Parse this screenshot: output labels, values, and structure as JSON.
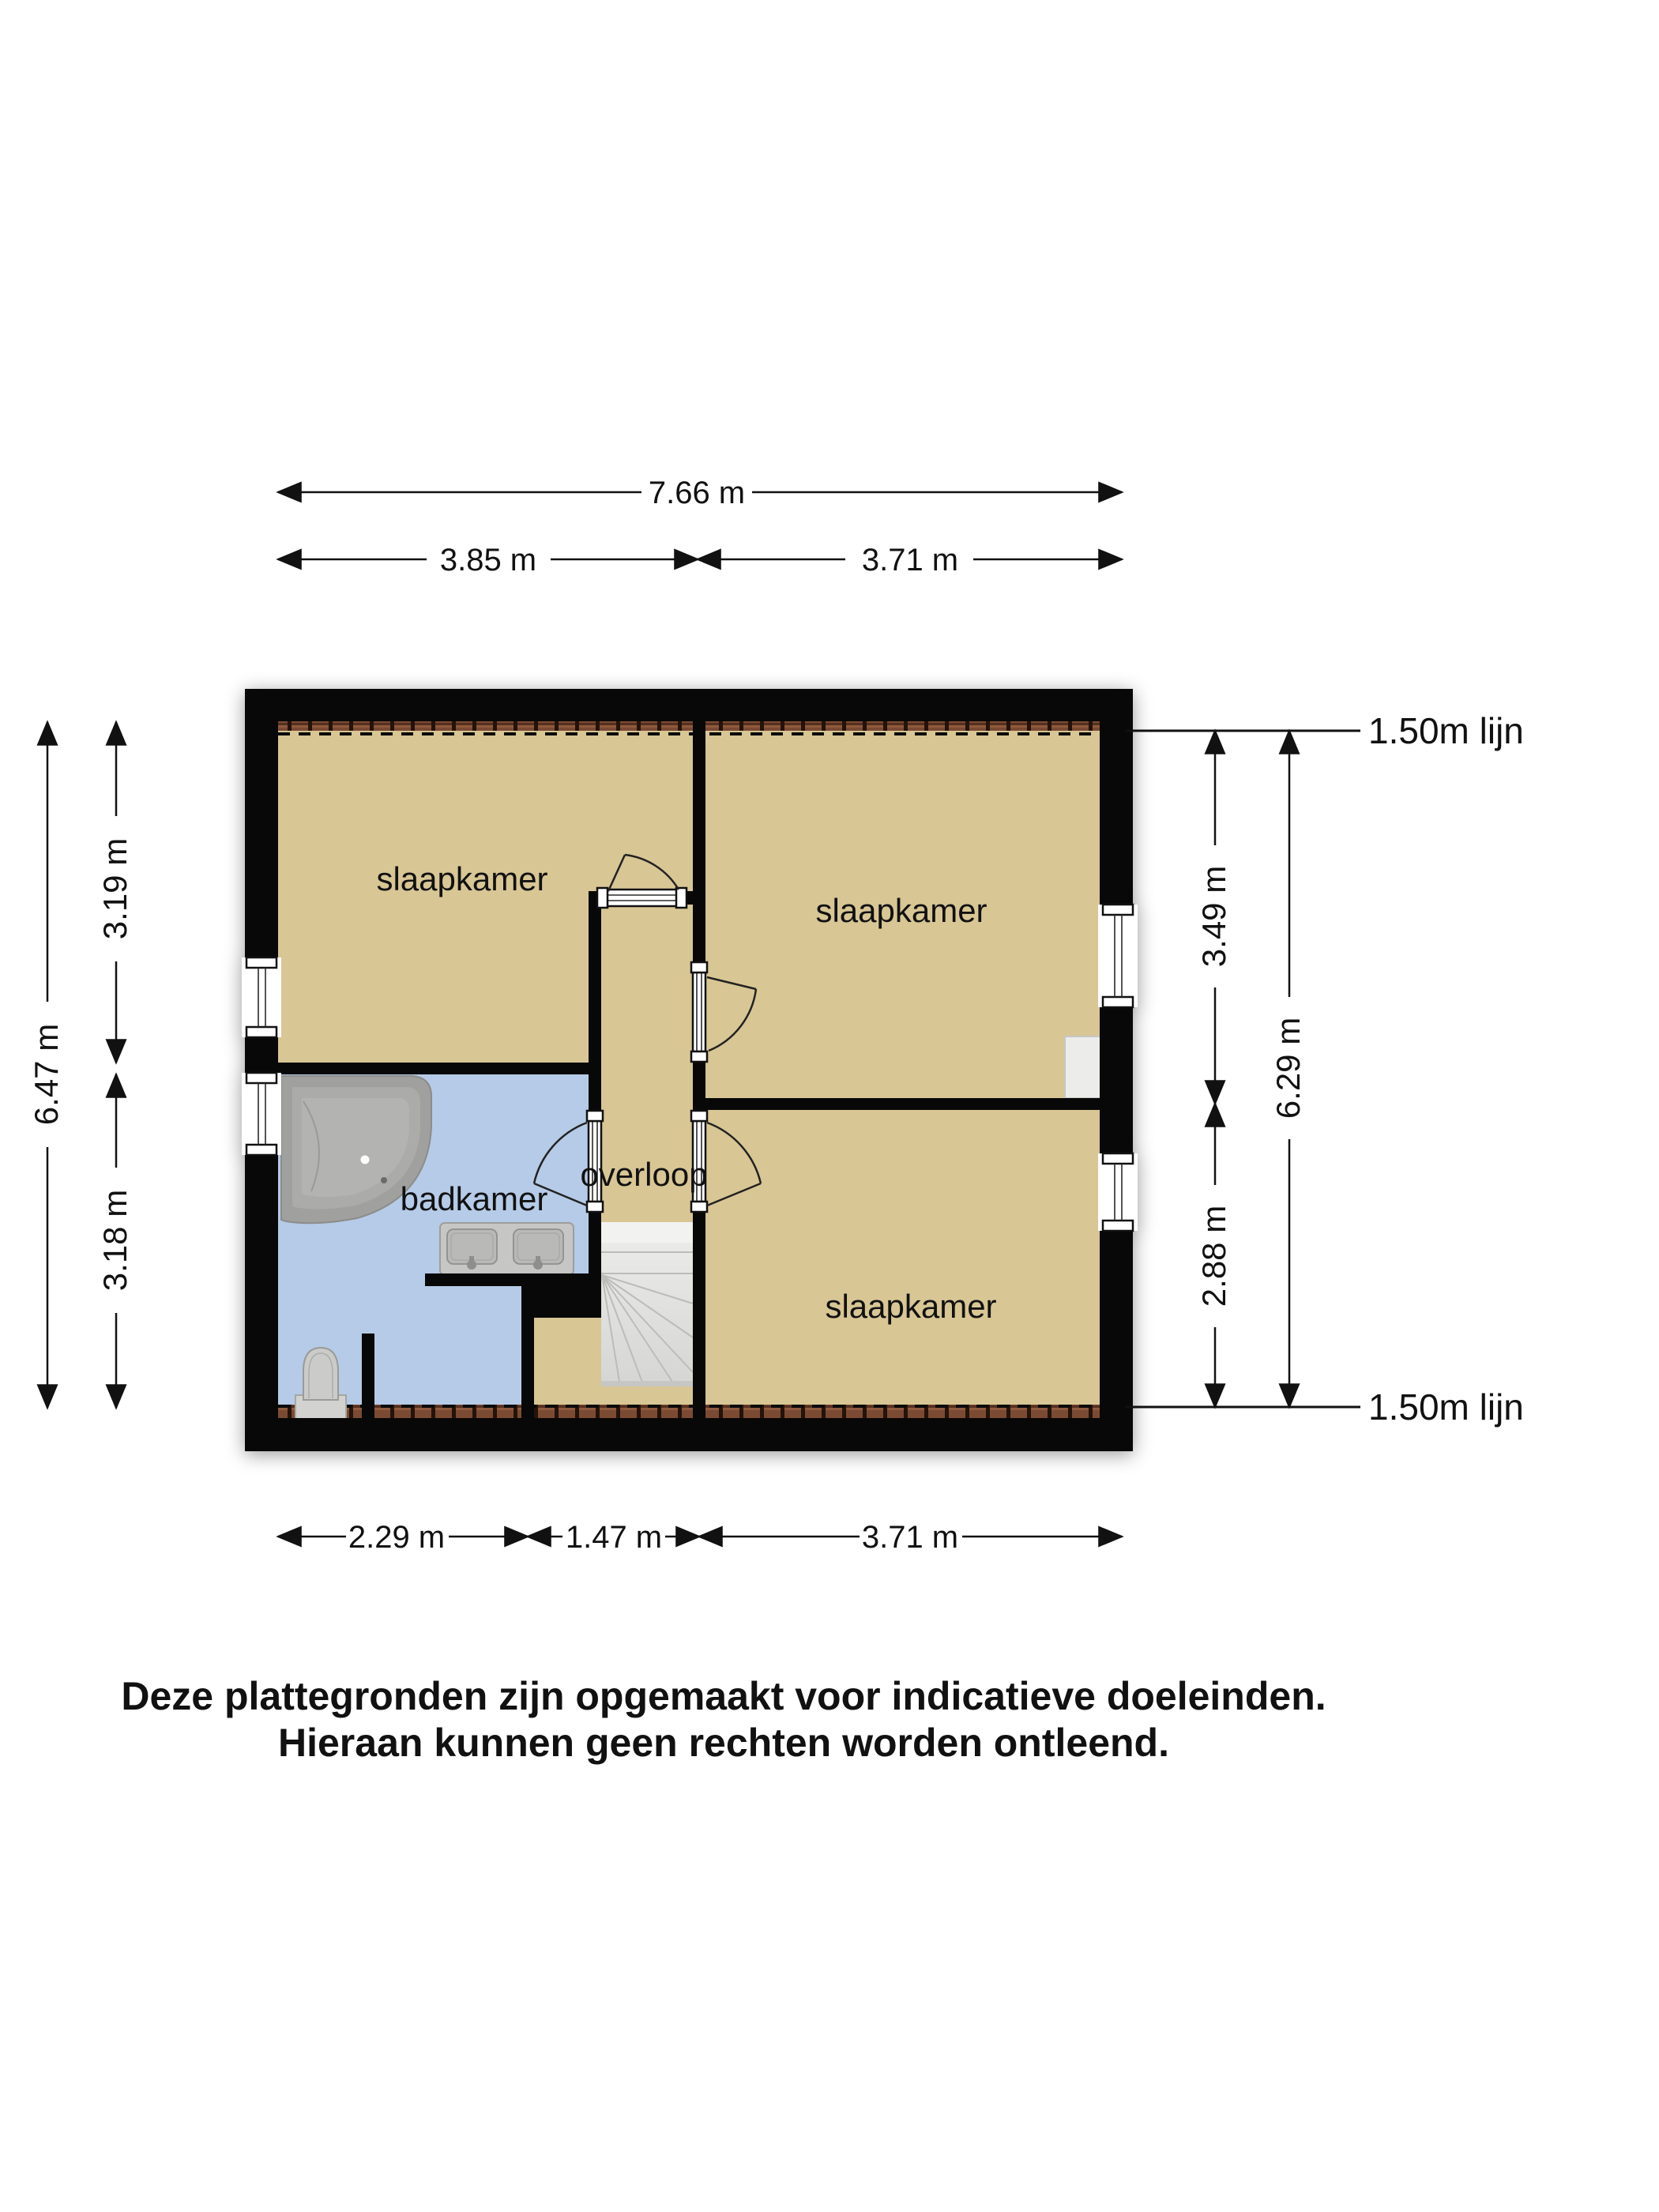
{
  "floorplan": {
    "rooms": {
      "bedroom_top_left": "slaapkamer",
      "bedroom_top_right": "slaapkamer",
      "bedroom_bottom_right": "slaapkamer",
      "bathroom": "badkamer",
      "landing": "overloop"
    },
    "dimensions": {
      "total_width": "7.66 m",
      "top_left_width": "3.85 m",
      "top_right_width": "3.71 m",
      "bottom_bathroom_width": "2.29 m",
      "bottom_stairs_width": "1.47 m",
      "bottom_right_width": "3.71 m",
      "left_total_height": "6.47 m",
      "left_top_height": "3.19 m",
      "left_bottom_height": "3.18 m",
      "right_top_height": "3.49 m",
      "right_bottom_height": "2.88 m",
      "right_total_height": "6.29 m",
      "roof_line_top": "1.50m lijn",
      "roof_line_bottom": "1.50m lijn"
    },
    "disclaimer": {
      "line1": "Deze plattegronden zijn opgemaakt voor indicatieve doeleinden.",
      "line2": "Hieraan kunnen geen rechten worden ontleend."
    },
    "colors": {
      "wall": "#080808",
      "floor_rooms": "#d8c694",
      "floor_bathroom": "#b5cbe7",
      "brick_band": "#7b4a33",
      "stairs": "#e6e6e4",
      "fixtures": "#c6c6c4",
      "niche": "#ececea"
    }
  }
}
